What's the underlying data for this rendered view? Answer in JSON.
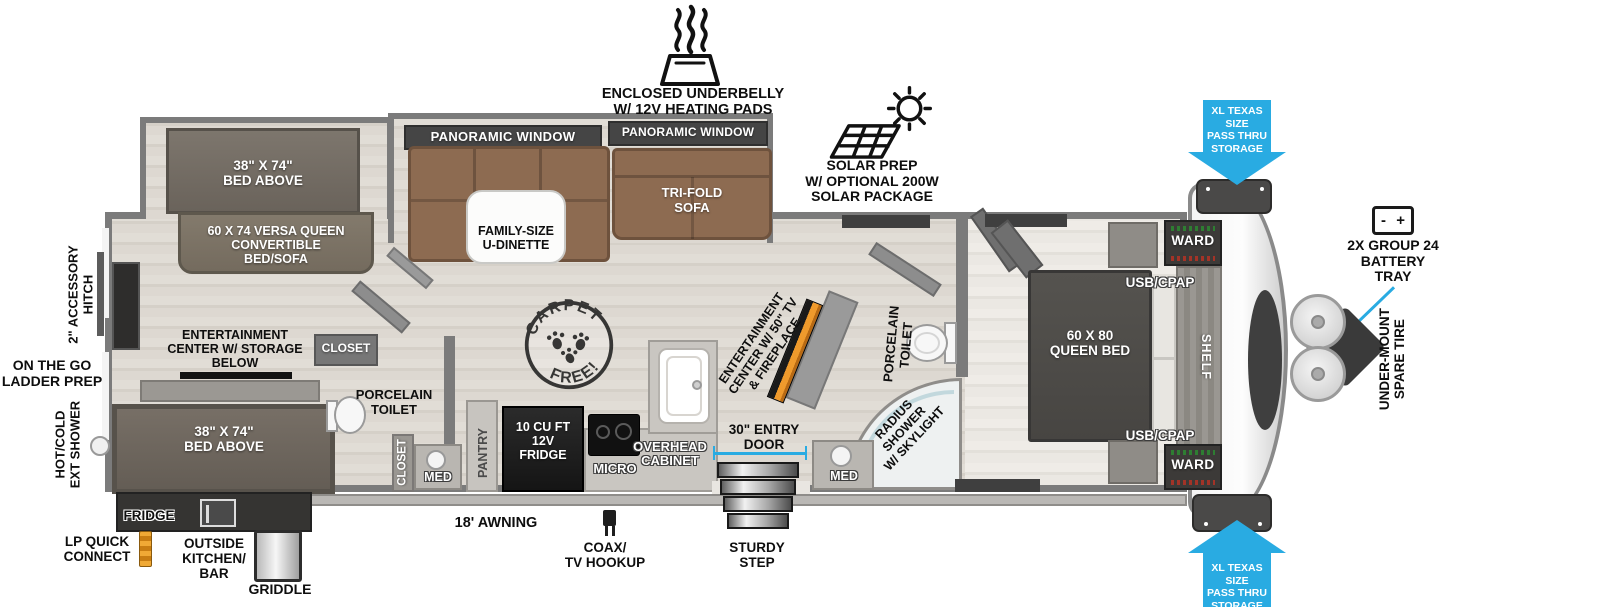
{
  "colors": {
    "accent_blue": "#29ABE2",
    "wall_gray": "#7b7b7b",
    "sofa_brown": "#8d6b51",
    "fireplace_orange": "#EF9A2C"
  },
  "exterior": {
    "underbelly_label": "ENCLOSED UNDERBELLY\nW/ 12V HEATING PADS",
    "solar_label": "SOLAR PREP\nW/ OPTIONAL 200W\nSOLAR PACKAGE",
    "pass_thru_top": "XL TEXAS SIZE\nPASS THRU\nSTORAGE",
    "pass_thru_bottom": "XL TEXAS SIZE\nPASS THRU\nSTORAGE",
    "battery_tray_label": "2X GROUP 24\nBATTERY\nTRAY",
    "battery_minus": "-",
    "battery_plus": "+",
    "spare_tire_label": "UNDER-MOUNT\nSPARE TIRE",
    "accessory_hitch_label": "2\" ACCESSORY\nHITCH",
    "ladder_prep_label": "ON THE GO\nLADDER PREP",
    "ext_shower_label": "HOT/COLD\nEXT SHOWER",
    "fridge_label": "FRIDGE",
    "lp_quick_connect_label": "LP QUICK\nCONNECT",
    "outside_kitchen_label": "OUTSIDE\nKITCHEN/\nBAR",
    "griddle_label": "GRIDDLE",
    "awning_label": "18' AWNING",
    "coax_label": "COAX/\nTV HOOKUP",
    "sturdy_step_label": "STURDY\nSTEP"
  },
  "interior": {
    "panoramic_window_left": "PANORAMIC WINDOW",
    "panoramic_window_right": "PANORAMIC WINDOW",
    "tri_fold_sofa": "TRI-FOLD\nSOFA",
    "u_dinette": "FAMILY-SIZE\nU-DINETTE",
    "bunk_top": "38\" X 74\"\nBED ABOVE",
    "versa_queen": "60 X 74 VERSA QUEEN\nCONVERTIBLE\nBED/SOFA",
    "entertainment_rear": "ENTERTAINMENT\nCENTER W/ STORAGE\nBELOW",
    "closet_upper": "CLOSET",
    "toilet_left": "PORCELAIN\nTOILET",
    "closet_lower": "CLOSET",
    "med_left": "MED",
    "bunk_bottom": "38\" X 74\"\nBED ABOVE",
    "pantry": "PANTRY",
    "fridge_12v": "10 CU FT\n12V\nFRIDGE",
    "micro": "MICRO",
    "overhead_cabinet": "OVERHEAD\nCABINET",
    "entry_door": "30\" ENTRY\nDOOR",
    "entertainment_tv": "ENTERTAINMENT\nCENTER W/ 50\" TV\n& FIREPLACE",
    "toilet_right": "PORCELAIN\nTOILET",
    "radius_shower": "RADIUS\nSHOWER\nW/ SKYLIGHT",
    "med_right": "MED",
    "queen_bed": "60 X  80\nQUEEN BED",
    "shelf": "SHELF",
    "ward_top": "WARD",
    "ward_bottom": "WARD",
    "usb_cpap_top": "USB/CPAP",
    "usb_cpap_bottom": "USB/CPAP",
    "carpet_free_top": "CARPET",
    "carpet_free_bottom": "FREE!"
  }
}
